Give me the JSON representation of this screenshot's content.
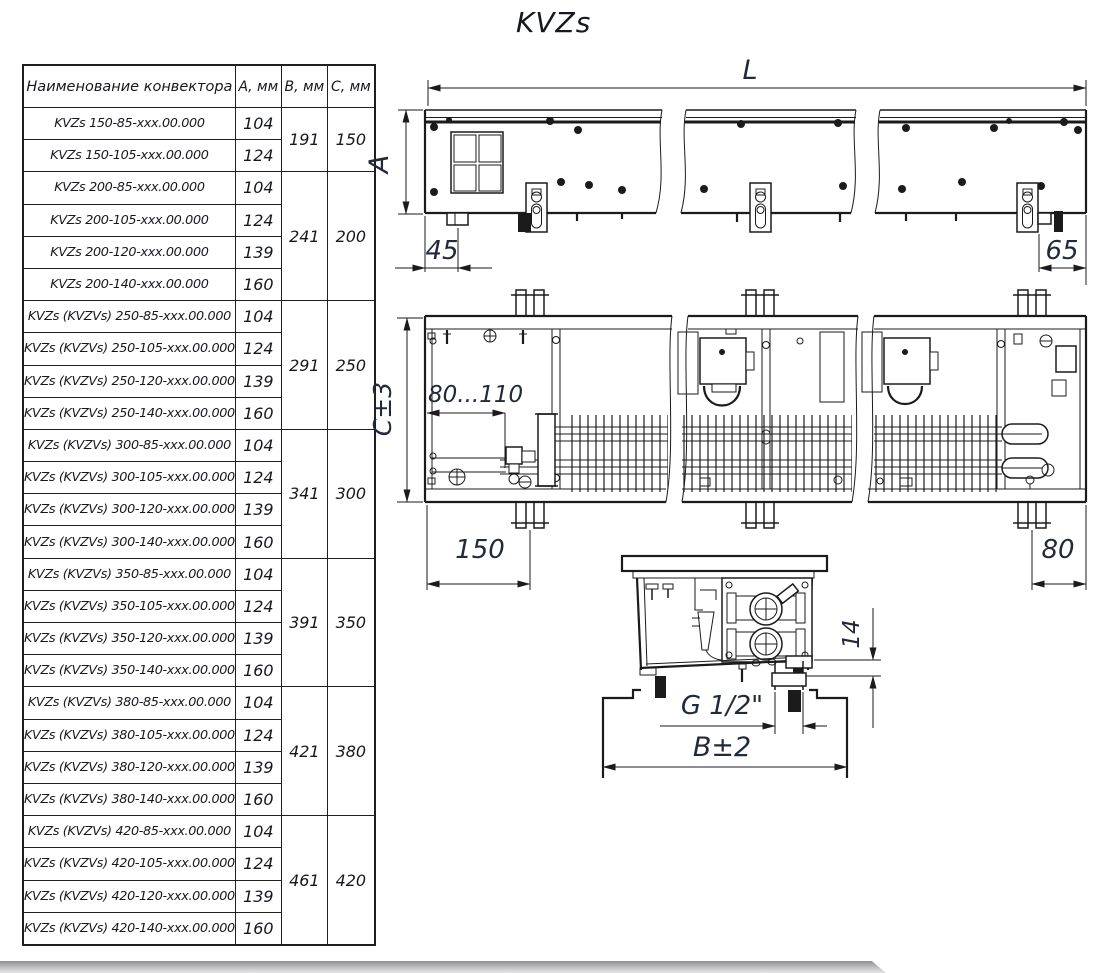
{
  "title": "KVZs",
  "table": {
    "headers": [
      "Наименование конвектора",
      "А, мм",
      "В, мм",
      "С, мм"
    ],
    "groups": [
      {
        "b": "191",
        "c": "150",
        "rows": [
          [
            "KVZs 150-85-xxx.00.000",
            "104"
          ],
          [
            "KVZs 150-105-xxx.00.000",
            "124"
          ]
        ]
      },
      {
        "b": "241",
        "c": "200",
        "rows": [
          [
            "KVZs 200-85-xxx.00.000",
            "104"
          ],
          [
            "KVZs 200-105-xxx.00.000",
            "124"
          ],
          [
            "KVZs 200-120-xxx.00.000",
            "139"
          ],
          [
            "KVZs 200-140-xxx.00.000",
            "160"
          ]
        ]
      },
      {
        "b": "291",
        "c": "250",
        "rows": [
          [
            "KVZs (KVZVs) 250-85-xxx.00.000",
            "104"
          ],
          [
            "KVZs (KVZVs) 250-105-xxx.00.000",
            "124"
          ],
          [
            "KVZs (KVZVs) 250-120-xxx.00.000",
            "139"
          ],
          [
            "KVZs (KVZVs) 250-140-xxx.00.000",
            "160"
          ]
        ]
      },
      {
        "b": "341",
        "c": "300",
        "rows": [
          [
            "KVZs (KVZVs) 300-85-xxx.00.000",
            "104"
          ],
          [
            "KVZs (KVZVs) 300-105-xxx.00.000",
            "124"
          ],
          [
            "KVZs (KVZVs) 300-120-xxx.00.000",
            "139"
          ],
          [
            "KVZs (KVZVs) 300-140-xxx.00.000",
            "160"
          ]
        ]
      },
      {
        "b": "391",
        "c": "350",
        "rows": [
          [
            "KVZs (KVZVs) 350-85-xxx.00.000",
            "104"
          ],
          [
            "KVZs (KVZVs) 350-105-xxx.00.000",
            "124"
          ],
          [
            "KVZs (KVZVs) 350-120-xxx.00.000",
            "139"
          ],
          [
            "KVZs (KVZVs) 350-140-xxx.00.000",
            "160"
          ]
        ]
      },
      {
        "b": "421",
        "c": "380",
        "rows": [
          [
            "KVZs (KVZVs) 380-85-xxx.00.000",
            "104"
          ],
          [
            "KVZs (KVZVs) 380-105-xxx.00.000",
            "124"
          ],
          [
            "KVZs (KVZVs) 380-120-xxx.00.000",
            "139"
          ],
          [
            "KVZs (KVZVs) 380-140-xxx.00.000",
            "160"
          ]
        ]
      },
      {
        "b": "461",
        "c": "420",
        "rows": [
          [
            "KVZs (KVZVs) 420-85-xxx.00.000",
            "104"
          ],
          [
            "KVZs (KVZVs) 420-105-xxx.00.000",
            "124"
          ],
          [
            "KVZs (KVZVs) 420-120-xxx.00.000",
            "139"
          ],
          [
            "KVZs (KVZVs) 420-140-xxx.00.000",
            "160"
          ]
        ]
      }
    ]
  },
  "drawings": {
    "front_view": {
      "dim_length": "L",
      "dim_height": "A",
      "dim_left": "45",
      "dim_right": "65"
    },
    "plan_view": {
      "dim_height": "С±3",
      "dim_range": "80...110",
      "dim_left": "150",
      "dim_right": "80"
    },
    "side_view": {
      "dim_thread": "G 1/2\"",
      "dim_width": "B±2",
      "dim_gap": "14"
    }
  }
}
